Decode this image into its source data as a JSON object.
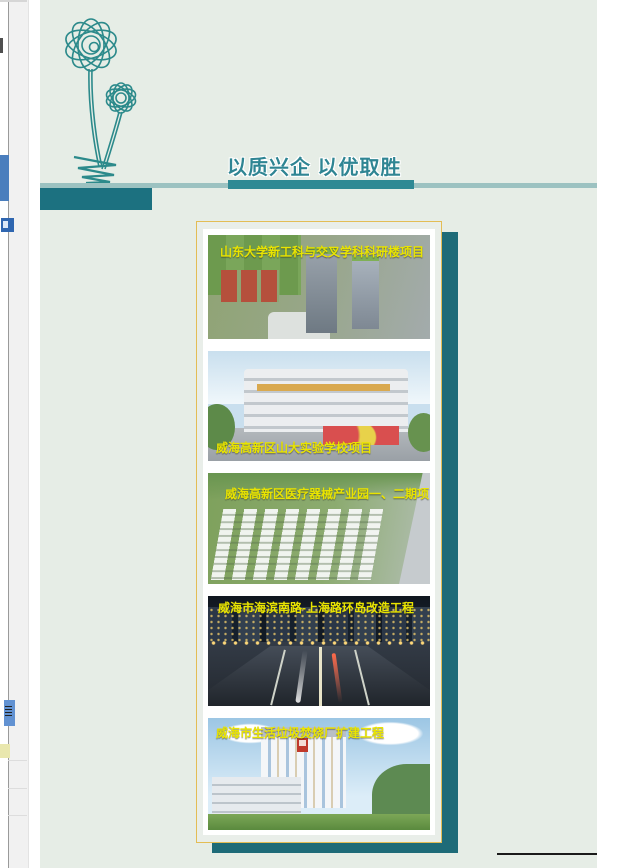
{
  "theme": {
    "page_background": "#e6ede6",
    "outer_background": "#ffffff",
    "teal_dark": "#1c7180",
    "teal_light": "#9cc2c1",
    "slogan_teal": "#2f8593",
    "panel_border_gold": "#e3bd55",
    "panel_shadow_teal": "#1e6b78",
    "caption_yellow": "#e9e400",
    "footer_rule_black": "#1a1a1a",
    "flower_line_teal": "#2c8a8b"
  },
  "header": {
    "slogan": "以质兴企 以优取胜",
    "flower_icon": "daffodil-line-art"
  },
  "projects": [
    {
      "caption": "山东大学新工科与交叉学科科研楼项目",
      "caption_position": "top"
    },
    {
      "caption": "威海高新区山大实验学校项目",
      "caption_position": "bottom"
    },
    {
      "caption": "威海高新区医疗器械产业园一、二期项目",
      "caption_position": "top"
    },
    {
      "caption": "威海市海滨南路-上海路环岛改造工程",
      "caption_position": "top"
    },
    {
      "caption": "威海市生活垃圾焚烧厂扩建工程",
      "caption_position": "top"
    }
  ]
}
